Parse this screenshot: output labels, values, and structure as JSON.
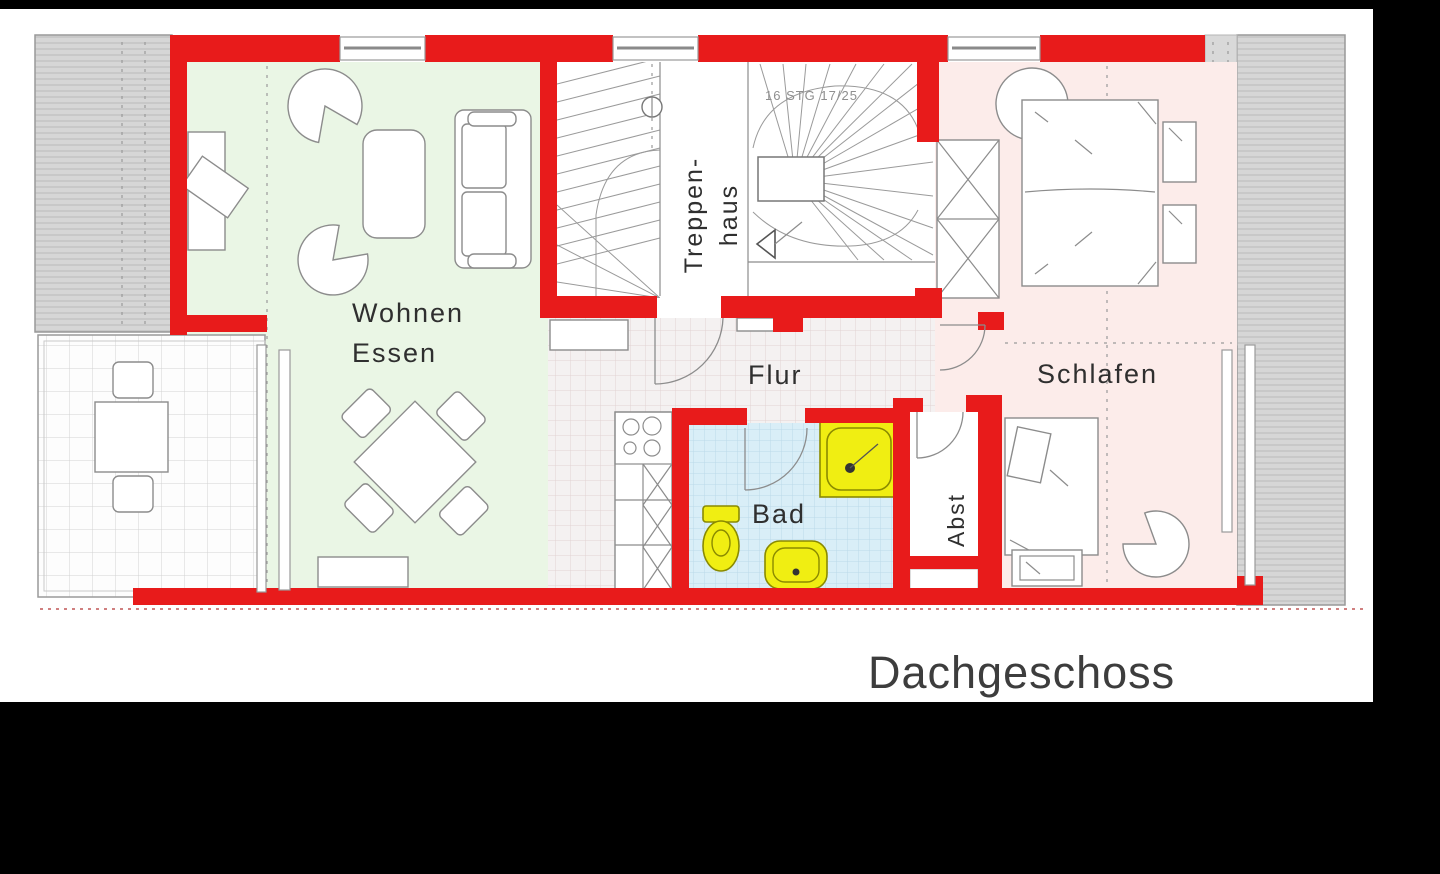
{
  "plan": {
    "title": "Dachgeschoss",
    "rooms": {
      "living": {
        "line1": "Wohnen",
        "line2": "Essen"
      },
      "stairwell": {
        "line1": "Treppen-",
        "line2": "haus",
        "note": "16 STG 17/25"
      },
      "hall": {
        "label": "Flur"
      },
      "bath": {
        "label": "Bad"
      },
      "storage": {
        "label": "Abst"
      },
      "bedroom": {
        "label": "Schlafen"
      }
    }
  },
  "colors": {
    "wall_red": "#e81b1b",
    "living_green": "#eaf6e5",
    "bedroom_pink": "#fcecea",
    "bath_blue": "#d9eef7",
    "fixture_yellow": "#f0ee12",
    "roof_gray": "#d6d6d6",
    "frame_black": "#000000"
  }
}
